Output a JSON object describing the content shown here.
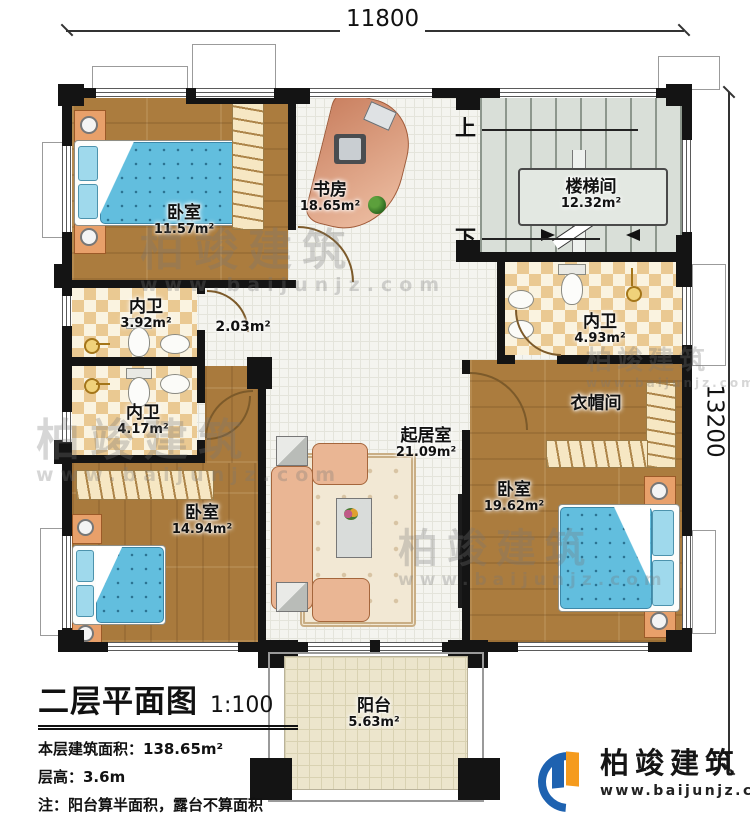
{
  "dimensions": {
    "width_label": "11800",
    "depth_label": "13200"
  },
  "rooms": {
    "bedroom_tl": {
      "name": "卧室",
      "area": "11.57m²"
    },
    "study": {
      "name": "书房",
      "area": "18.65m²"
    },
    "stairwell": {
      "name": "楼梯间",
      "area": "12.32m²"
    },
    "bath_a": {
      "name": "内卫",
      "area": "3.92m²"
    },
    "hall": {
      "area": "2.03m²"
    },
    "bath_b": {
      "name": "内卫",
      "area": "4.17m²"
    },
    "bath_c": {
      "name": "内卫",
      "area": "4.93m²"
    },
    "cloakroom": {
      "name": "衣帽间"
    },
    "bedroom_bl": {
      "name": "卧室",
      "area": "14.94m²"
    },
    "living": {
      "name": "起居室",
      "area": "21.09m²"
    },
    "bedroom_br": {
      "name": "卧室",
      "area": "19.62m²"
    },
    "balcony": {
      "name": "阳台",
      "area": "5.63m²"
    }
  },
  "stairs": {
    "up": "上",
    "down": "下"
  },
  "title_block": {
    "title": "二层平面图",
    "scale": "1:100",
    "area_line": "本层建筑面积：138.65m²",
    "height_line": "层高：3.6m",
    "note_line": "注：阳台算半面积，露台不算面积"
  },
  "brand": {
    "name": "柏竣建筑",
    "website": "www.baijunjz.com"
  },
  "watermark": {
    "name": "柏竣建筑",
    "website": "www.baijunjz.com"
  },
  "colors": {
    "wall": "#141414",
    "wood_floor": "#ab7c3e",
    "tile_floor": "#f4f4ef",
    "checker_tile": "#eac992",
    "stair_floor": "#d9dfd8",
    "balcony_floor": "#ece5cc",
    "bed_blue": "#62bede",
    "sofa_peach": "#eab694",
    "brand_blue": "#1e62b0",
    "brand_orange": "#f59b1e"
  }
}
